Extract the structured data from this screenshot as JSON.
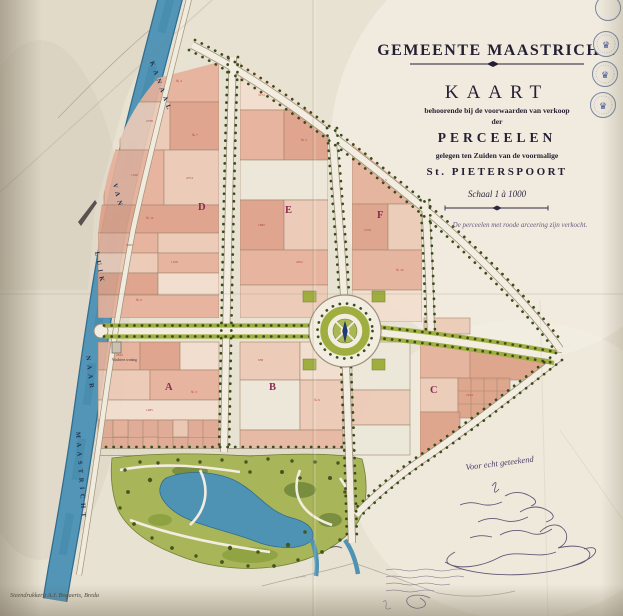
{
  "title_block": {
    "municipality": "GEMEENTE MAASTRICHT.",
    "map_word": "KAART",
    "line1": "behoorende bij de voorwaarden van verkoop",
    "line2": "der",
    "line3": "PERCEELEN",
    "line4": "gelegen ten Zuiden van de voormalige",
    "line5": "St. PIETERSPOORT",
    "scale": "Schaal 1 à 1000",
    "note": "De perceelen met roode arceering zijn verkocht."
  },
  "canal_labels": [
    "KANAAL",
    "VAN",
    "LUIK",
    "NAAR",
    "MAASTRICHT"
  ],
  "sections": [
    "A",
    "B",
    "C",
    "D",
    "E",
    "F"
  ],
  "building_label": "Wachters woning",
  "handwriting": {
    "certified": "Voor echt geteekend"
  },
  "printer_credit": "Steendrukkerij A.J. Bogaerts, Breda",
  "stamps": {
    "crown": "♛"
  },
  "parcel_marks": [
    "№ 4",
    "2738",
    "№ 7",
    "1520",
    "4374",
    "№ 12",
    "2265",
    "1108",
    "№ 9",
    "3172",
    "№ 2",
    "1890",
    "2052",
    "№ 5",
    "1376",
    "№ 10",
    "2610",
    "№ 3",
    "1485",
    "938",
    "№ 6",
    "2194"
  ],
  "colors": {
    "paper": "#e8e2d2",
    "canal_blue": "#5295b6",
    "parcel_pink": "#e5b09a",
    "park_green": "#a9b559",
    "verge_green": "#9fae3e",
    "section_red": "#8e2a52",
    "ink": "#241f33"
  }
}
